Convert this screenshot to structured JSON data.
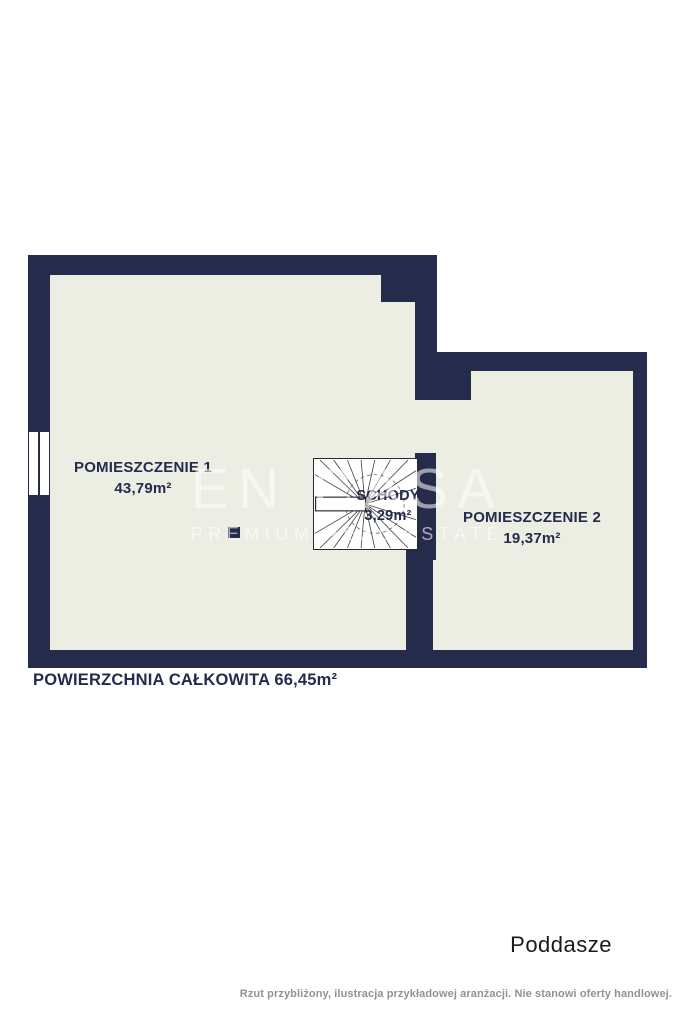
{
  "floorplan": {
    "rooms": [
      {
        "name": "POMIESZCZENIE 1",
        "area": "43,79m²"
      },
      {
        "name": "POMIESZCZENIE 2",
        "area": "19,37m²"
      },
      {
        "name": "SCHODY",
        "area": "3,29m²"
      }
    ],
    "total_label": "POWIERZCHNIA CAŁKOWITA 66,45m²"
  },
  "watermark": {
    "brand": "EN CASA",
    "tagline": "PREMIUM REAL ESTATE"
  },
  "footer": {
    "floor_label": "Poddasze",
    "disclaimer": "Rzut przybliżony, ilustracja przykładowej aranżacji. Nie stanowi oferty handlowej."
  },
  "colors": {
    "wall": "#252B4B",
    "floor": "#ECEDE3",
    "page": "#FFFFFF",
    "label_text": "#252B4B",
    "footer_text": "#1A1A1A",
    "disclaimer_text": "#8D939B",
    "watermark": "#FFFFFF"
  }
}
